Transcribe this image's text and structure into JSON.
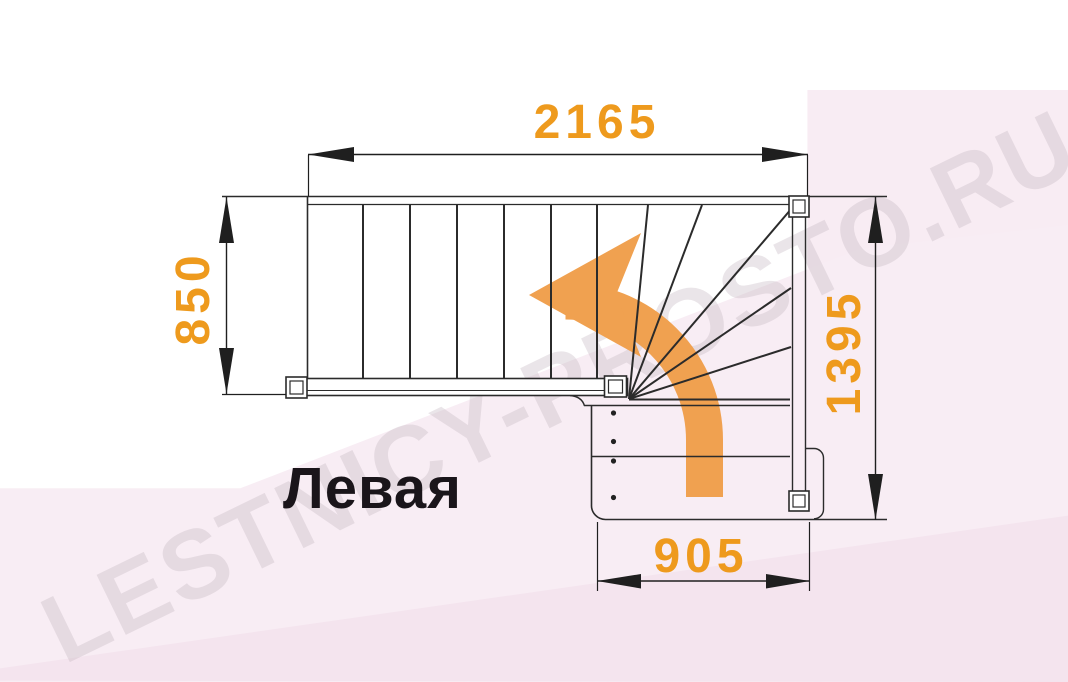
{
  "diagram": {
    "title_label": "Левая",
    "watermark_text": "LESTNICY-PROSTO.RU",
    "dimensions": {
      "top_width_mm": "2165",
      "left_height_mm": "850",
      "right_height_mm": "1395",
      "bottom_width_mm": "905"
    },
    "stair": {
      "description": "L-shaped (90-degree turn) staircase plan with winder steps, left turn",
      "upper_flight_vertical_tread_lines": 6,
      "winder_fan_lines": 6,
      "lower_flight_tread_lines": 2,
      "newel_posts": 4,
      "baluster_dots": 4,
      "turn_direction": "left"
    },
    "colors": {
      "dimension_text_orange": "#ee9a1d",
      "arrow_orange": "#f0a150",
      "line_black": "#2b2b2b",
      "background_pink": "#f8ecf3",
      "watermark_gray": "#c3b6bf"
    }
  }
}
